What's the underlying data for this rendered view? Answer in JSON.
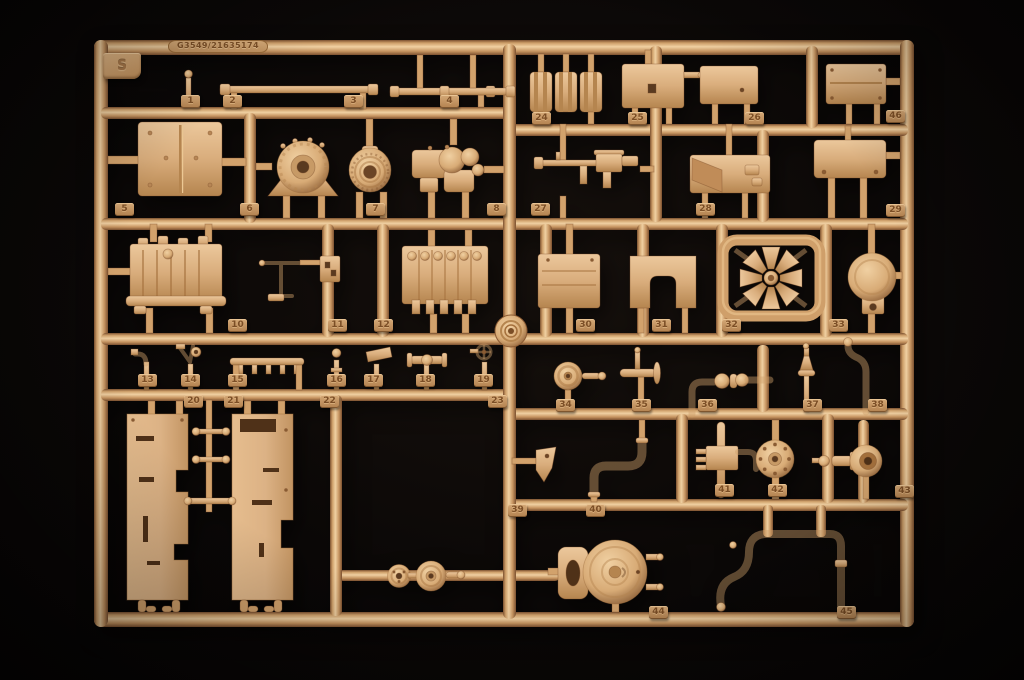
{
  "scene": {
    "subject": "tan plastic model kit sprue photographed on black background",
    "background_color": "#0a0706"
  },
  "sprue": {
    "mold_code": "G3549/21635174",
    "sprue_letter": "S",
    "colors": {
      "plastic_highlight": "#f2d2a4",
      "plastic_mid": "#d0a06c",
      "plastic_shadow": "#7c5130",
      "tag_fill": "#c49a68",
      "tag_text": "#7b4e26"
    },
    "part_tags": [
      {
        "label": "1",
        "x": 181,
        "y": 95
      },
      {
        "label": "2",
        "x": 223,
        "y": 95
      },
      {
        "label": "3",
        "x": 344,
        "y": 95
      },
      {
        "label": "4",
        "x": 440,
        "y": 95
      },
      {
        "label": "5",
        "x": 115,
        "y": 203
      },
      {
        "label": "6",
        "x": 240,
        "y": 203
      },
      {
        "label": "7",
        "x": 366,
        "y": 203
      },
      {
        "label": "8",
        "x": 487,
        "y": 203
      },
      {
        "label": "10",
        "x": 228,
        "y": 319
      },
      {
        "label": "11",
        "x": 328,
        "y": 319
      },
      {
        "label": "12",
        "x": 374,
        "y": 319
      },
      {
        "label": "13",
        "x": 138,
        "y": 374
      },
      {
        "label": "14",
        "x": 181,
        "y": 374
      },
      {
        "label": "15",
        "x": 228,
        "y": 374
      },
      {
        "label": "16",
        "x": 327,
        "y": 374
      },
      {
        "label": "17",
        "x": 364,
        "y": 374
      },
      {
        "label": "18",
        "x": 416,
        "y": 374
      },
      {
        "label": "19",
        "x": 474,
        "y": 374
      },
      {
        "label": "20",
        "x": 184,
        "y": 395
      },
      {
        "label": "21",
        "x": 224,
        "y": 395
      },
      {
        "label": "22",
        "x": 320,
        "y": 395
      },
      {
        "label": "23",
        "x": 488,
        "y": 395
      },
      {
        "label": "24",
        "x": 532,
        "y": 112
      },
      {
        "label": "25",
        "x": 628,
        "y": 112
      },
      {
        "label": "26",
        "x": 745,
        "y": 112
      },
      {
        "label": "27",
        "x": 531,
        "y": 203
      },
      {
        "label": "28",
        "x": 696,
        "y": 203
      },
      {
        "label": "29",
        "x": 886,
        "y": 204
      },
      {
        "label": "30",
        "x": 576,
        "y": 319
      },
      {
        "label": "31",
        "x": 652,
        "y": 319
      },
      {
        "label": "32",
        "x": 722,
        "y": 319
      },
      {
        "label": "33",
        "x": 829,
        "y": 319
      },
      {
        "label": "34",
        "x": 556,
        "y": 399
      },
      {
        "label": "35",
        "x": 632,
        "y": 399
      },
      {
        "label": "36",
        "x": 698,
        "y": 399
      },
      {
        "label": "37",
        "x": 803,
        "y": 399
      },
      {
        "label": "38",
        "x": 868,
        "y": 399
      },
      {
        "label": "39",
        "x": 508,
        "y": 504
      },
      {
        "label": "40",
        "x": 586,
        "y": 504
      },
      {
        "label": "41",
        "x": 715,
        "y": 484
      },
      {
        "label": "42",
        "x": 768,
        "y": 484
      },
      {
        "label": "43",
        "x": 895,
        "y": 485
      },
      {
        "label": "44",
        "x": 649,
        "y": 606
      },
      {
        "label": "45",
        "x": 837,
        "y": 606
      },
      {
        "label": "46",
        "x": 886,
        "y": 110
      }
    ]
  }
}
